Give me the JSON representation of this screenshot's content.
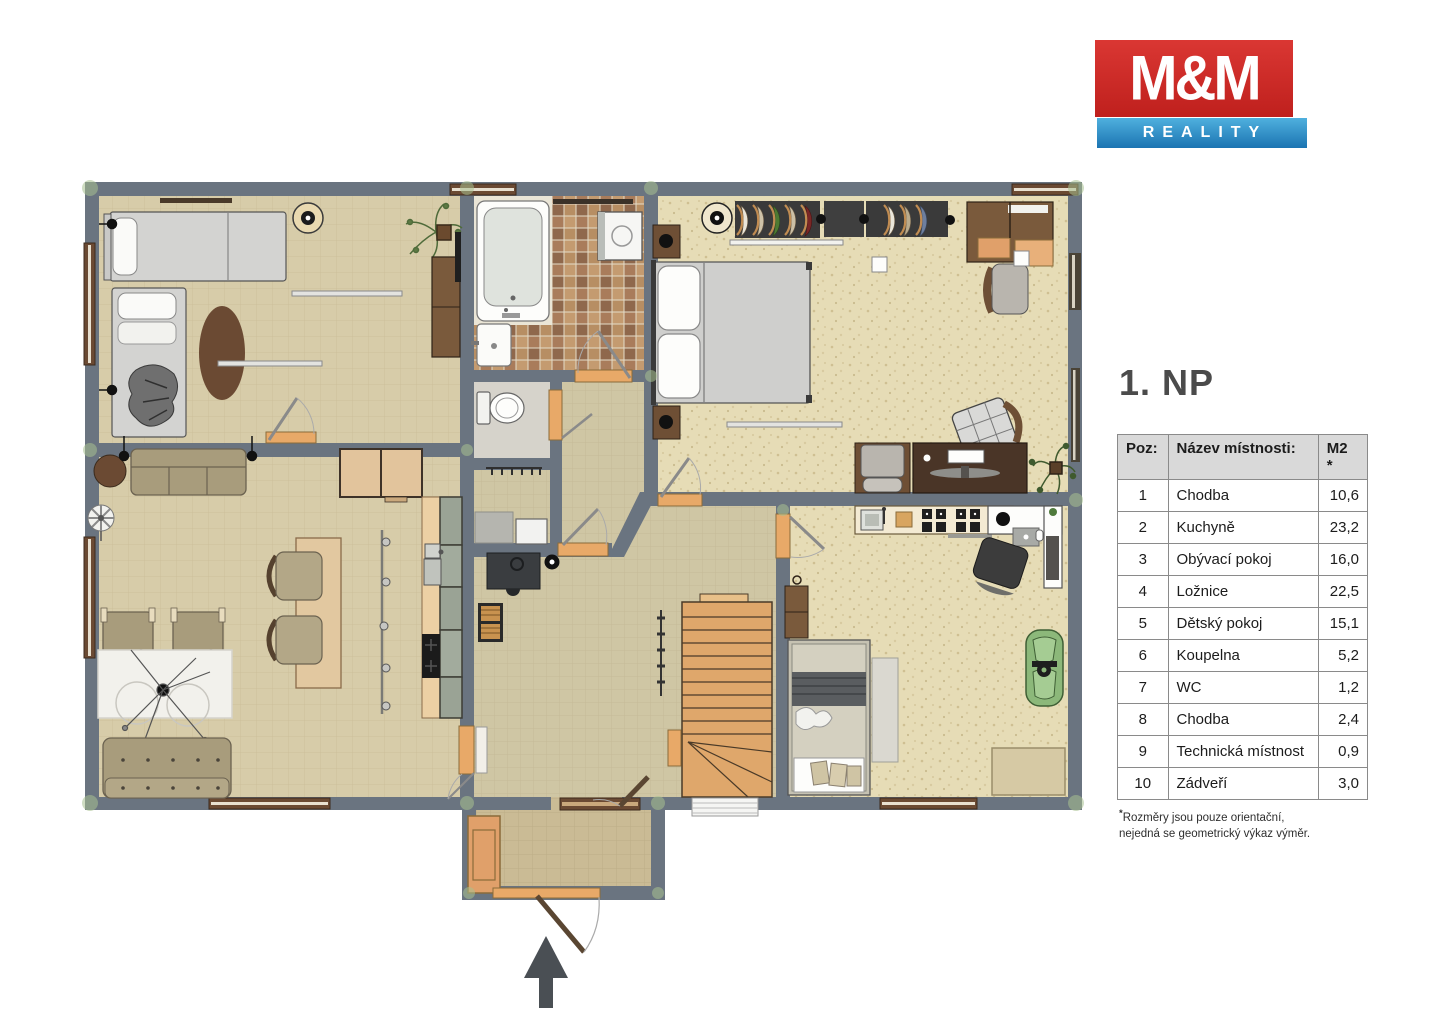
{
  "logo": {
    "mm": "M&M",
    "reality": "REALITY",
    "brand_red": "#c9302d",
    "brand_blue": "#2f8fc6"
  },
  "floor_title": "1. NP",
  "table": {
    "headers": {
      "poz": "Poz:",
      "name": "Název místnosti:",
      "m2": "M2",
      "m2_note": "*"
    },
    "rows": [
      {
        "poz": "1",
        "name": "Chodba",
        "m2": "10,6"
      },
      {
        "poz": "2",
        "name": "Kuchyně",
        "m2": "23,2"
      },
      {
        "poz": "3",
        "name": "Obývací pokoj",
        "m2": "16,0"
      },
      {
        "poz": "4",
        "name": "Ložnice",
        "m2": "22,5"
      },
      {
        "poz": "5",
        "name": "Dětský pokoj",
        "m2": "15,1"
      },
      {
        "poz": "6",
        "name": "Koupelna",
        "m2": "5,2"
      },
      {
        "poz": "7",
        "name": "WC",
        "m2": "1,2"
      },
      {
        "poz": "8",
        "name": "Chodba",
        "m2": "2,4"
      },
      {
        "poz": "9",
        "name": "Technická místnost",
        "m2": "0,9"
      },
      {
        "poz": "10",
        "name": "Zádveří",
        "m2": "3,0"
      }
    ]
  },
  "footnote": {
    "star": "*",
    "line1": "Rozměry jsou pouze orientační,",
    "line2": "nejedná se geometrický výkaz výměr."
  },
  "plan_colors": {
    "wall": "#6a7480",
    "floor": "#d7cca9",
    "stairs": "#dfa76b",
    "door_threshold": "#e8a968"
  }
}
